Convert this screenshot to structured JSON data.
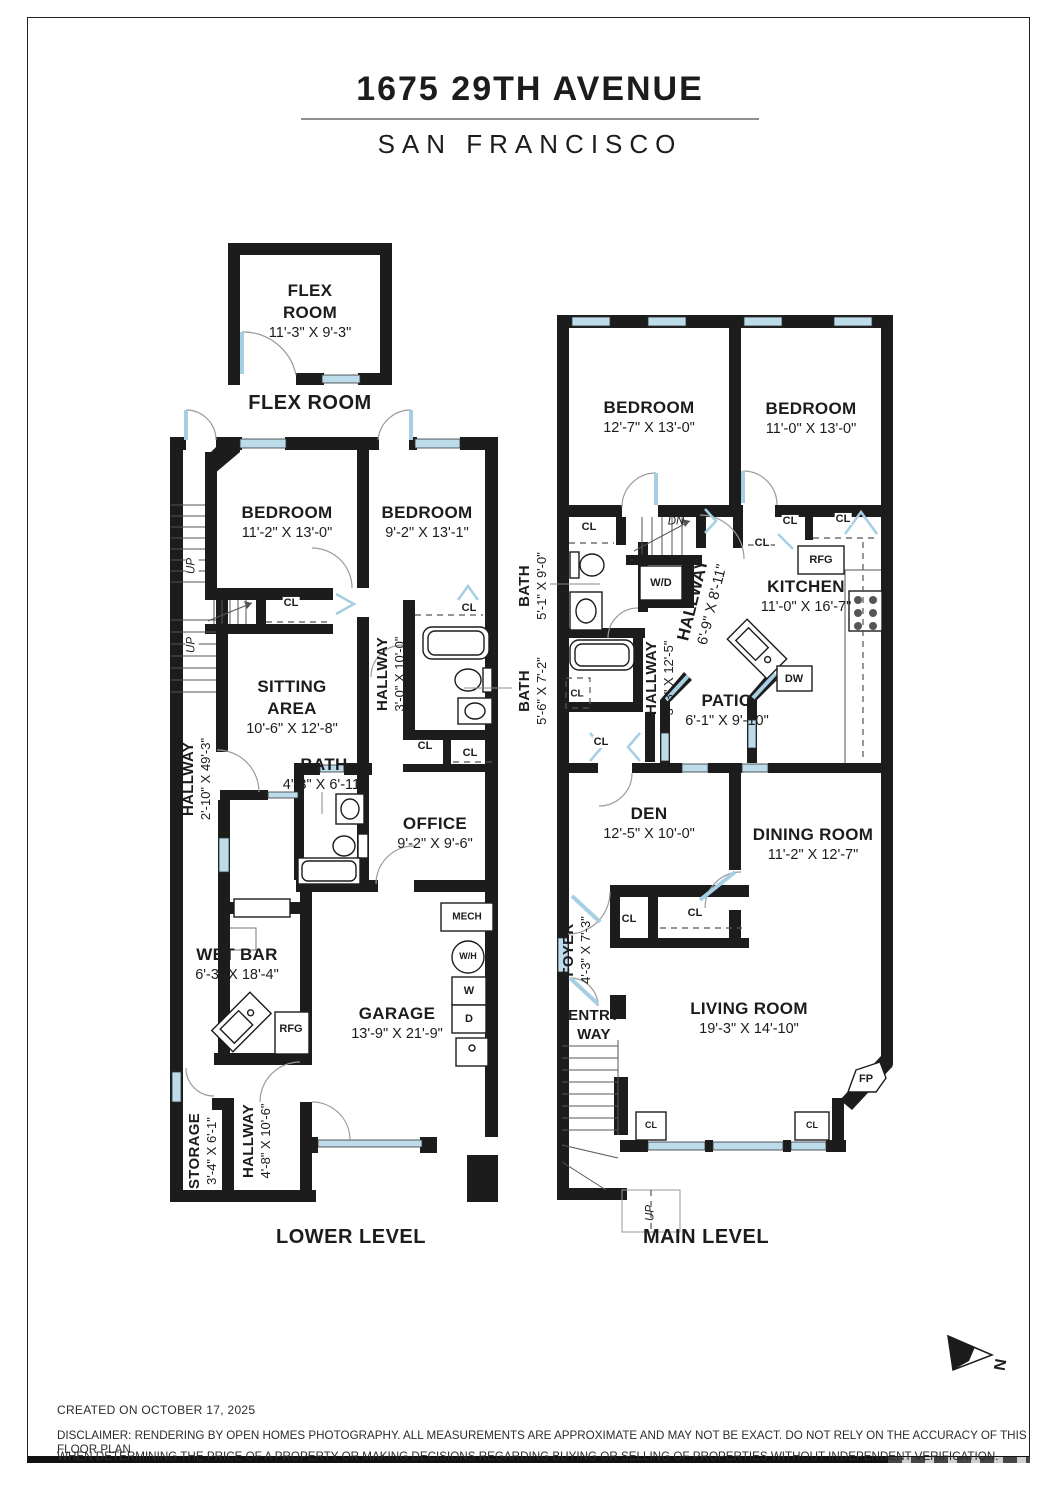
{
  "title": {
    "address": "1675 29TH AVENUE",
    "city": "SAN FRANCISCO"
  },
  "captions": {
    "flex": "FLEX ROOM",
    "lower": "LOWER LEVEL",
    "main": "MAIN LEVEL"
  },
  "abbr": {
    "cl": "CL",
    "rfg": "RFG",
    "dw": "DW",
    "wd": "W/D",
    "mech": "MECH",
    "wh": "W/H",
    "w": "W",
    "d": "D",
    "fp": "FP",
    "up": "UP",
    "dn": "DN",
    "north": "N"
  },
  "lower": {
    "flex": {
      "name1": "FLEX",
      "name2": "ROOM",
      "dims": "11'-3\" X 9'-3\""
    },
    "bedroom_left": {
      "name": "BEDROOM",
      "dims": "11'-2\" X 13'-0\""
    },
    "bedroom_right": {
      "name": "BEDROOM",
      "dims": "9'-2\" X 13'-1\""
    },
    "hallway_side": {
      "name": "HALLWAY",
      "dims": "2'-10\" X 49'-3\""
    },
    "sitting": {
      "name1": "SITTING",
      "name2": "AREA",
      "dims": "10'-6\" X 12'-8\""
    },
    "hallway_mid": {
      "name": "HALLWAY",
      "dims": "3'-0\" X 10'-0\""
    },
    "bath": {
      "name": "BATH",
      "dims": "4'-3\" X 6'-11\""
    },
    "office": {
      "name": "OFFICE",
      "dims": "9'-2\" X 9'-6\""
    },
    "wet_bar": {
      "name": "WET BAR",
      "dims": "6'-3\" X 18'-4\""
    },
    "garage": {
      "name": "GARAGE",
      "dims": "13'-9\" X 21'-9\""
    },
    "storage": {
      "name": "STORAGE",
      "dims": "3'-4\" X 6'-1\""
    },
    "hallway_bottom": {
      "name": "HALLWAY",
      "dims": "4'-8\" X 10'-6\""
    }
  },
  "main": {
    "bedroom_left": {
      "name": "BEDROOM",
      "dims": "12'-7\" X 13'-0\""
    },
    "bedroom_right": {
      "name": "BEDROOM",
      "dims": "11'-0\" X 13'-0\""
    },
    "bath_upper": {
      "name": "BATH",
      "dims": "5'-1\" X 9'-0\""
    },
    "bath_lower": {
      "name": "BATH",
      "dims": "5'-6\" X 7'-2\""
    },
    "hallway_upper": {
      "name": "HALLWAY",
      "dims": "6'-9\" X 8'-11\""
    },
    "hallway_lower": {
      "name": "HALLWAY",
      "dims": "3'-3\" X 12'-5\""
    },
    "kitchen": {
      "name": "KITCHEN",
      "dims": "11'-0\" X 16'-7\""
    },
    "patio": {
      "name": "PATIO",
      "dims": "6'-1\" X 9'-10\""
    },
    "den": {
      "name": "DEN",
      "dims": "12'-5\" X 10'-0\""
    },
    "dining": {
      "name": "DINING ROOM",
      "dims": "11'-2\" X 12'-7\""
    },
    "foyer": {
      "name": "FOYER",
      "dims": "4'-3\" X 7'-3\""
    },
    "living": {
      "name": "LIVING ROOM",
      "dims": "19'-3\" X 14'-10\""
    },
    "entry": {
      "name1": "ENTRY",
      "name2": "WAY"
    }
  },
  "footer": {
    "created": "CREATED ON OCTOBER 17, 2025",
    "disclaimer1": "DISCLAIMER: RENDERING BY OPEN HOMES PHOTOGRAPHY. ALL MEASUREMENTS ARE APPROXIMATE AND MAY NOT BE EXACT. DO NOT RELY ON THE ACCURACY OF THIS FLOOR PLAN",
    "disclaimer2": "WHEN DETERMINING THE PRICE OF A PROPERTY OR MAKING DECISIONS REGARDING BUYING OR SELLING OF PROPERTIES WITHOUT INDEPENDENT VERIFICATION."
  },
  "colors": {
    "wall": "#1c1c1c",
    "window": "#bcdcec",
    "door_leaf": "#a6cfe3",
    "text": "#1c1c1c"
  }
}
